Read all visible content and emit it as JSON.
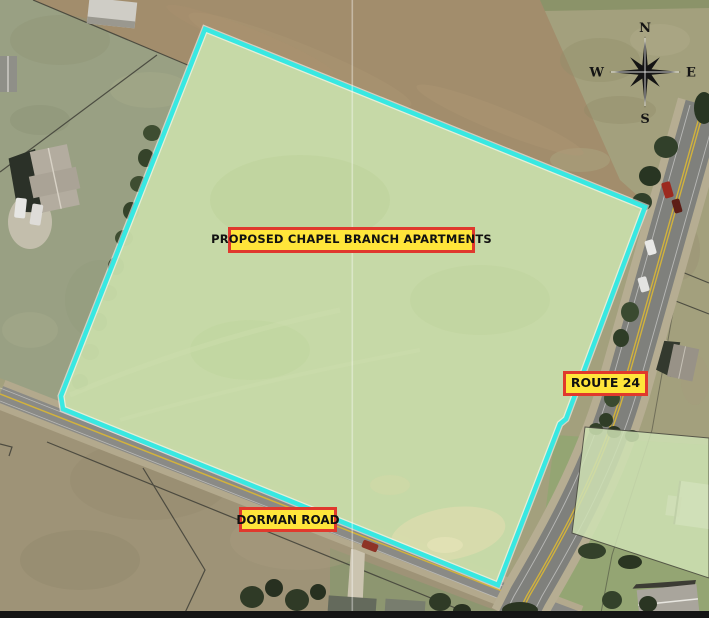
{
  "labels": {
    "site": "PROPOSED CHAPEL BRANCH APARTMENTS",
    "route": "ROUTE 24",
    "road": "DORMAN ROAD"
  },
  "compass": {
    "north": "N",
    "south": "S",
    "east": "E",
    "west": "W"
  },
  "colors": {
    "site_fill": "#c7dba8",
    "site_outline": "#38e8e2",
    "label_background": "#ffe53a",
    "label_border": "#e0392d",
    "label_text": "#111111",
    "road_centerline_yellow": "#d2b23c",
    "compass_black": "#141414"
  },
  "icons": {
    "compass": "compass-rose-8-point-star"
  }
}
